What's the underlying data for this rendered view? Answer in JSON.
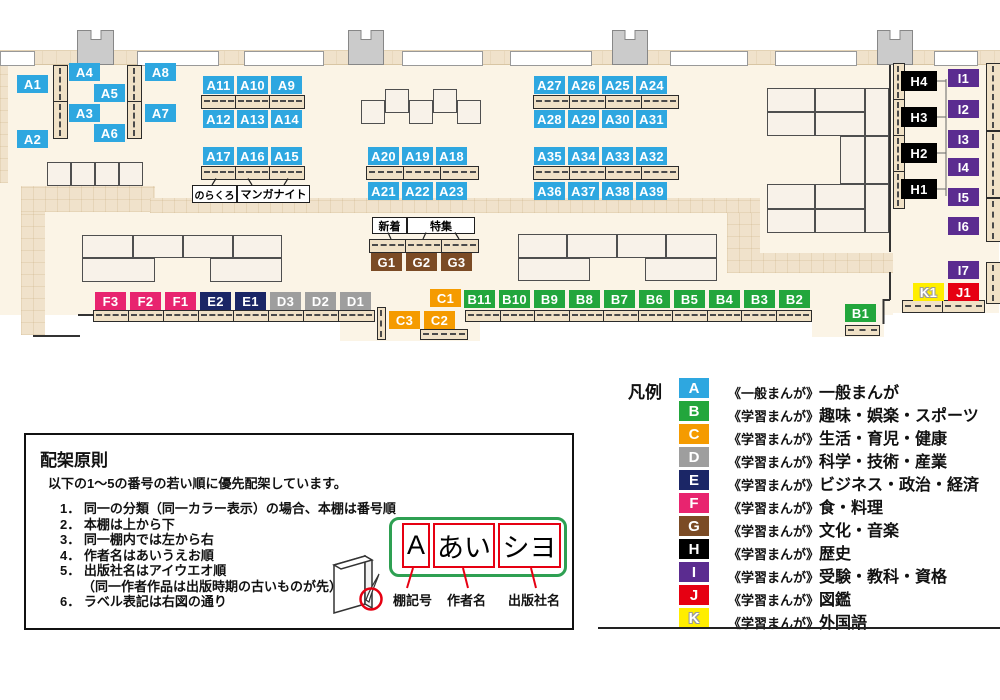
{
  "map": {
    "colors": {
      "A": "#2EA7E0",
      "B": "#22A63C",
      "C": "#F59B00",
      "D": "#9E9E9E",
      "E": "#1B2666",
      "F": "#E8246F",
      "G": "#7B4B25",
      "H": "#000000",
      "I": "#5B2C90",
      "J": "#E60012",
      "K": "#FFEE00"
    },
    "shelf_labels": [
      {
        "id": "A1",
        "x": 17,
        "y": 75
      },
      {
        "id": "A2",
        "x": 17,
        "y": 130
      },
      {
        "id": "A4",
        "x": 69,
        "y": 63
      },
      {
        "id": "A3",
        "x": 69,
        "y": 104
      },
      {
        "id": "A5",
        "x": 94,
        "y": 84
      },
      {
        "id": "A6",
        "x": 94,
        "y": 124
      },
      {
        "id": "A8",
        "x": 145,
        "y": 63
      },
      {
        "id": "A7",
        "x": 145,
        "y": 104
      },
      {
        "id": "A11",
        "x": 203,
        "y": 76
      },
      {
        "id": "A10",
        "x": 237,
        "y": 76
      },
      {
        "id": "A9",
        "x": 271,
        "y": 76
      },
      {
        "id": "A12",
        "x": 203,
        "y": 110
      },
      {
        "id": "A13",
        "x": 237,
        "y": 110
      },
      {
        "id": "A14",
        "x": 271,
        "y": 110
      },
      {
        "id": "A17",
        "x": 203,
        "y": 147
      },
      {
        "id": "A16",
        "x": 237,
        "y": 147
      },
      {
        "id": "A15",
        "x": 271,
        "y": 147
      },
      {
        "id": "A20",
        "x": 368,
        "y": 147
      },
      {
        "id": "A19",
        "x": 402,
        "y": 147
      },
      {
        "id": "A18",
        "x": 436,
        "y": 147
      },
      {
        "id": "A21",
        "x": 368,
        "y": 182
      },
      {
        "id": "A22",
        "x": 402,
        "y": 182
      },
      {
        "id": "A23",
        "x": 436,
        "y": 182
      },
      {
        "id": "A27",
        "x": 534,
        "y": 76
      },
      {
        "id": "A26",
        "x": 568,
        "y": 76
      },
      {
        "id": "A25",
        "x": 602,
        "y": 76
      },
      {
        "id": "A24",
        "x": 636,
        "y": 76
      },
      {
        "id": "A28",
        "x": 534,
        "y": 110
      },
      {
        "id": "A29",
        "x": 568,
        "y": 110
      },
      {
        "id": "A30",
        "x": 602,
        "y": 110
      },
      {
        "id": "A31",
        "x": 636,
        "y": 110
      },
      {
        "id": "A35",
        "x": 534,
        "y": 147
      },
      {
        "id": "A34",
        "x": 568,
        "y": 147
      },
      {
        "id": "A33",
        "x": 602,
        "y": 147
      },
      {
        "id": "A32",
        "x": 636,
        "y": 147
      },
      {
        "id": "A36",
        "x": 534,
        "y": 182
      },
      {
        "id": "A37",
        "x": 568,
        "y": 182
      },
      {
        "id": "A38",
        "x": 602,
        "y": 182
      },
      {
        "id": "A39",
        "x": 636,
        "y": 182
      },
      {
        "id": "G1",
        "x": 371,
        "y": 253
      },
      {
        "id": "G2",
        "x": 406,
        "y": 253
      },
      {
        "id": "G3",
        "x": 441,
        "y": 253
      },
      {
        "id": "F3",
        "x": 95,
        "y": 292
      },
      {
        "id": "F2",
        "x": 130,
        "y": 292
      },
      {
        "id": "F1",
        "x": 165,
        "y": 292
      },
      {
        "id": "E2",
        "x": 200,
        "y": 292
      },
      {
        "id": "E1",
        "x": 235,
        "y": 292
      },
      {
        "id": "D3",
        "x": 270,
        "y": 292
      },
      {
        "id": "D2",
        "x": 305,
        "y": 292
      },
      {
        "id": "D1",
        "x": 340,
        "y": 292
      },
      {
        "id": "C1",
        "x": 430,
        "y": 289
      },
      {
        "id": "B11",
        "x": 464,
        "y": 290
      },
      {
        "id": "B10",
        "x": 499,
        "y": 290
      },
      {
        "id": "B9",
        "x": 534,
        "y": 290
      },
      {
        "id": "B8",
        "x": 569,
        "y": 290
      },
      {
        "id": "B7",
        "x": 604,
        "y": 290
      },
      {
        "id": "B6",
        "x": 639,
        "y": 290
      },
      {
        "id": "B5",
        "x": 674,
        "y": 290
      },
      {
        "id": "B4",
        "x": 709,
        "y": 290
      },
      {
        "id": "B3",
        "x": 744,
        "y": 290
      },
      {
        "id": "B2",
        "x": 779,
        "y": 290
      },
      {
        "id": "C3",
        "x": 389,
        "y": 311
      },
      {
        "id": "C2",
        "x": 424,
        "y": 311
      },
      {
        "id": "B1",
        "x": 845,
        "y": 304
      },
      {
        "id": "H4",
        "x": 901,
        "y": 71,
        "w": 36,
        "h": 20
      },
      {
        "id": "H3",
        "x": 901,
        "y": 107,
        "w": 36,
        "h": 20
      },
      {
        "id": "H2",
        "x": 901,
        "y": 143,
        "w": 36,
        "h": 20
      },
      {
        "id": "H1",
        "x": 901,
        "y": 179,
        "w": 36,
        "h": 20
      },
      {
        "id": "I1",
        "x": 948,
        "y": 69
      },
      {
        "id": "I2",
        "x": 948,
        "y": 100
      },
      {
        "id": "I3",
        "x": 948,
        "y": 130
      },
      {
        "id": "I4",
        "x": 948,
        "y": 158
      },
      {
        "id": "I5",
        "x": 948,
        "y": 188
      },
      {
        "id": "I6",
        "x": 948,
        "y": 217
      },
      {
        "id": "I7",
        "x": 948,
        "y": 261
      },
      {
        "id": "K1",
        "x": 913,
        "y": 283
      },
      {
        "id": "J1",
        "x": 948,
        "y": 283
      }
    ],
    "callouts": [
      {
        "name": "norakuro",
        "text": "のらくろ",
        "x": 192,
        "y": 185,
        "w": 43,
        "h": 16,
        "fs": 10
      },
      {
        "name": "manga-night",
        "text": "マンガナイト",
        "x": 237,
        "y": 185,
        "w": 71,
        "h": 16,
        "fs": 11
      },
      {
        "name": "new-arrivals",
        "text": "新着",
        "x": 372,
        "y": 217,
        "w": 33,
        "h": 15,
        "fs": 11
      },
      {
        "name": "feature",
        "text": "特集",
        "x": 407,
        "y": 217,
        "w": 66,
        "h": 15,
        "fs": 11
      }
    ]
  },
  "legend": {
    "title": "凡例",
    "rows": [
      {
        "letter": "A",
        "maker": "《一般まんが》",
        "category": "一般まんが"
      },
      {
        "letter": "B",
        "maker": "《学習まんが》",
        "category": "趣味・娯楽・スポーツ"
      },
      {
        "letter": "C",
        "maker": "《学習まんが》",
        "category": "生活・育児・健康"
      },
      {
        "letter": "D",
        "maker": "《学習まんが》",
        "category": "科学・技術・産業"
      },
      {
        "letter": "E",
        "maker": "《学習まんが》",
        "category": "ビジネス・政治・経済"
      },
      {
        "letter": "F",
        "maker": "《学習まんが》",
        "category": "食・料理"
      },
      {
        "letter": "G",
        "maker": "《学習まんが》",
        "category": "文化・音楽"
      },
      {
        "letter": "H",
        "maker": "《学習まんが》",
        "category": "歴史"
      },
      {
        "letter": "I",
        "maker": "《学習まんが》",
        "category": "受験・教科・資格"
      },
      {
        "letter": "J",
        "maker": "《学習まんが》",
        "category": "図鑑"
      },
      {
        "letter": "K",
        "maker": "《学習まんが》",
        "category": "外国語"
      }
    ]
  },
  "principles": {
    "title": "配架原則",
    "intro": "以下の1～5の番号の若い順に優先配架しています。",
    "items": [
      {
        "num": "1．",
        "text": "同一の分類（同一カラー表示）の場合、本棚は番号順"
      },
      {
        "num": "2．",
        "text": "本棚は上から下"
      },
      {
        "num": "3．",
        "text": "同一棚内では左から右"
      },
      {
        "num": "4．",
        "text": "作者名はあいうえお順"
      },
      {
        "num": "5．",
        "text": "出版社名はアイウエオ順",
        "note": "（同一作者作品は出版時期の古いものが先）"
      },
      {
        "num": "6．",
        "text": "ラベル表記は右図の通り"
      }
    ],
    "diagram": {
      "shelf_code_value": "A",
      "author_value": "あい",
      "publisher_value": "シヨ",
      "shelf_code_label": "棚記号",
      "author_label": "作者名",
      "publisher_label": "出版社名"
    }
  }
}
